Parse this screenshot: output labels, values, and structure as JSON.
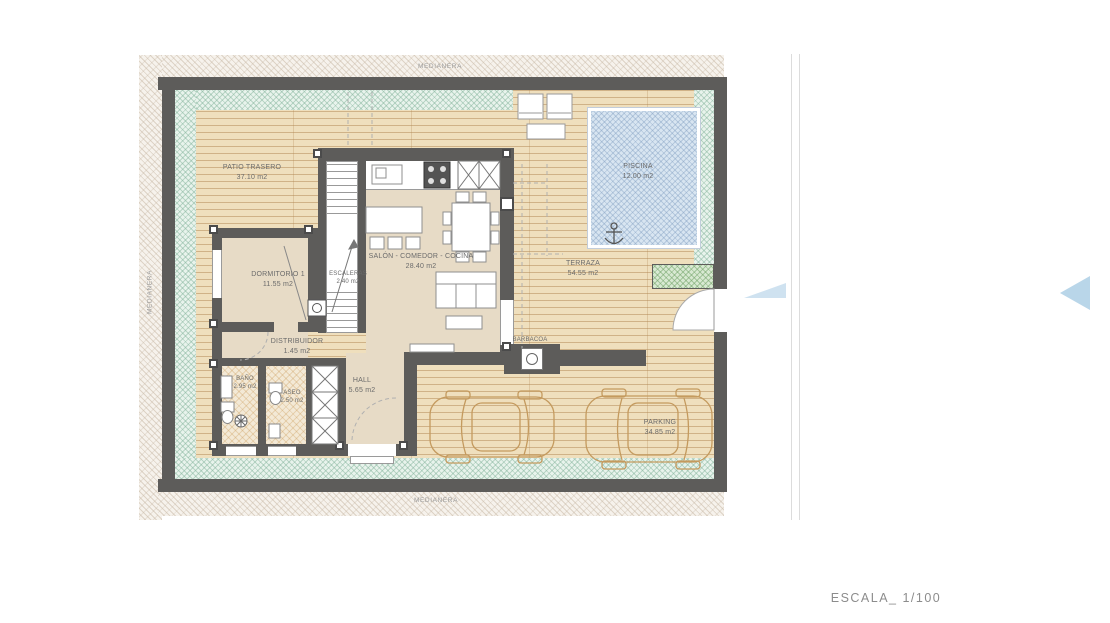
{
  "drawing": {
    "scale_label": "ESCALA_ 1/100",
    "boundary_label_top": "MEDIANERA",
    "boundary_label_left": "MEDIANERA",
    "boundary_label_bottom": "MEDIANERA",
    "rooms": {
      "patio_trasero": {
        "name": "PATIO TRASERO",
        "area": "37.10 m2"
      },
      "piscina": {
        "name": "PISCINA",
        "area": "12.00 m2"
      },
      "dormitorio1": {
        "name": "DORMITORIO 1",
        "area": "11.55 m2"
      },
      "escaleras": {
        "name": "ESCALERAS",
        "area": "2.40 m2"
      },
      "salon": {
        "name": "SALÓN - COMEDOR - COCINA",
        "area": "28.40 m2"
      },
      "terraza": {
        "name": "TERRAZA",
        "area": "54.55 m2"
      },
      "distribuidor": {
        "name": "DISTRIBUIDOR",
        "area": "1.45 m2"
      },
      "bano": {
        "name": "BAÑO",
        "area": "2.95 m2"
      },
      "aseo": {
        "name": "ASEO",
        "area": "2.50 m2"
      },
      "hall": {
        "name": "HALL",
        "area": "5.65 m2"
      },
      "barbacoa": {
        "name": "BARBACOA"
      },
      "parking": {
        "name": "PARKING",
        "area": "34.85 m2"
      }
    },
    "colors": {
      "wall": "#5d5c5a",
      "deck": "#efdfbd",
      "garden_strip": "#e8f3ec",
      "pool": "#d8e5f1",
      "grass": "#d8e9d2",
      "arrow": "#b9d6e9",
      "label_text": "#6b6b6b"
    }
  }
}
